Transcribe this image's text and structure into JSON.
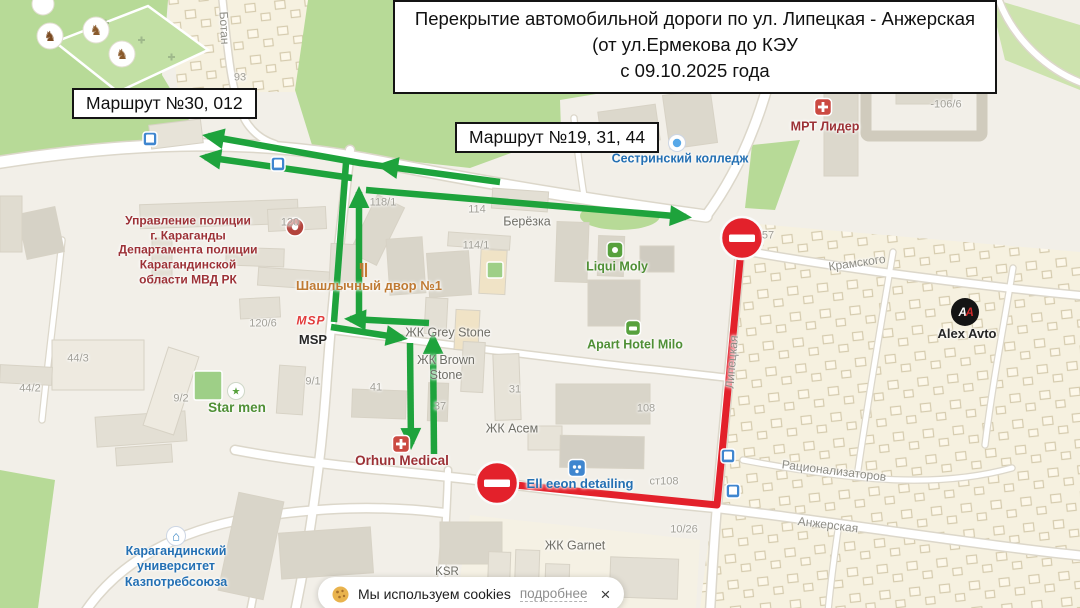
{
  "annotations": {
    "title_lines": [
      "Перекрытие автомобильной дороги по ул. Липецкая - Анжерская",
      "(от ул.Ермекова до КЭУ",
      "с 09.10.2025 года"
    ],
    "route_label_1": "Маршрут №30, 012",
    "route_label_2": "Маршрут №19, 31, 44"
  },
  "cookie_banner": {
    "message": "Мы используем cookies",
    "details_link": "подробнее",
    "close": "×"
  },
  "colors": {
    "detour_green": "#1ea33c",
    "closure_red": "#e3212b",
    "map_background": "#f2efe8",
    "park_green": "#b7da97"
  },
  "map": {
    "streets": {
      "kramskogo": "Крамского",
      "ratsionalizatorov": "Рационализаторов",
      "anzherskaya": "Анжерская",
      "lipetskaya": "Липецкая",
      "botanicheskaya": "Ботан"
    },
    "house_numbers": {
      "n93": "93",
      "n120": "120",
      "n118_1": "118/1",
      "n114": "114",
      "n114_1": "114/1",
      "n120_6": "120/6",
      "n44_3": "44/3",
      "n44_2": "44/2",
      "n9_2": "9/2",
      "n9_1": "9/1",
      "n41": "41",
      "n37": "37",
      "n31": "31",
      "n108": "108",
      "nst108": "ст108",
      "n10_26": "10/26",
      "n106_6": "-106/6",
      "n57": "57"
    },
    "pois": {
      "police": "Управление полиции\nг. Караганды\nДепартамента полиции\nКарагандинской\nобласти МВД РК",
      "mrt_lider": "МРТ Лидер",
      "berezka": "Берёзка",
      "liqui_moly": "Liqui Moly",
      "apart_hotel_milo": "Apart Hotel Milo",
      "star_men": "Star men",
      "shashlychny_dvor": "Шашлычный двор №1",
      "msp": "MSP",
      "msp_logo": "MSP",
      "zhk_grey_stone": "ЖК Grey Stone",
      "zhk_brown_stone": "ЖК Brown\nStone",
      "zhk_asem": "ЖК Асем",
      "zhk_garnet": "ЖК Garnet",
      "ksr": "KSR",
      "orhun_medical": "Orhun Medical",
      "ell_eeon": "Ell eeon detailing",
      "college": "Сестринский колледж",
      "university": "Карагандинский\nуниверситет\nКазпотребсоюза",
      "alex_avto": "Alex Avto"
    }
  }
}
